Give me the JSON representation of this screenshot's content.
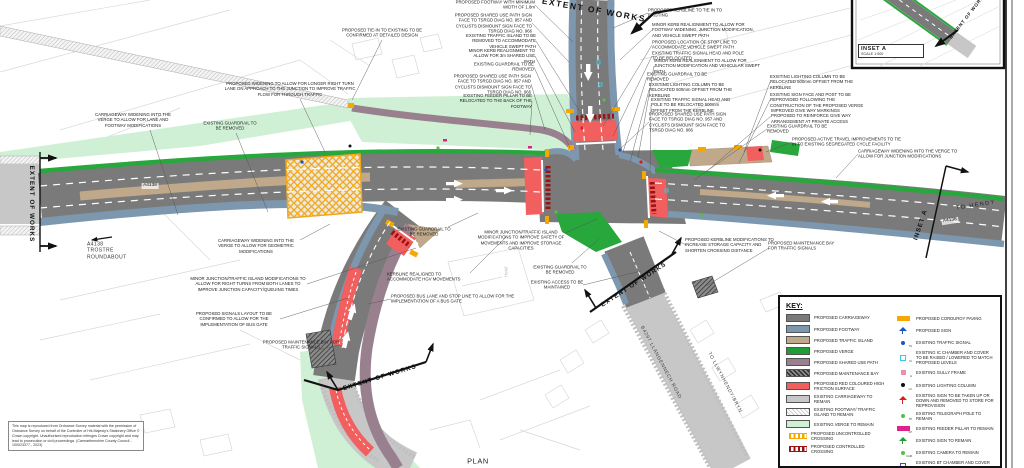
{
  "colors": {
    "proposed_carriageway": "#7a7a7a",
    "proposed_footway": "#7d97ae",
    "traffic_island": "#c0a88a",
    "proposed_verge": "#27a73c",
    "shared_use_path": "#99808f",
    "red_surface": "#f15f5f",
    "existing_carriageway": "#c7c7c7",
    "existing_verge": "#cff0d4",
    "corduroy": "#f5a800",
    "controlled_crossing": "#9b1313",
    "sign_blue": "#1657c7",
    "sign_red": "#d81f1f",
    "sign_green": "#1e9e35"
  },
  "inset": {
    "title": "INSET A",
    "scale": "SCALE 1:500"
  },
  "plan_title": "PLAN",
  "notes": "This map is reproduced from Ordnance Survey material with the permission of Ordnance Survey on behalf of the Controller of His Majesty's Stationery Office © Crown copyright. Unauthorised reproduction infringes Crown copyright and may lead to prosecution or civil proceedings. (Carmarthenshire County Council - 100023377 - 2023)",
  "key": {
    "title": "KEY:",
    "left": [
      {
        "label": "PROPOSED CARRIAGEWAY",
        "type": "solid",
        "color": "#7a7a7a"
      },
      {
        "label": "PROPOSED FOOTWAY",
        "type": "solid",
        "color": "#7d97ae"
      },
      {
        "label": "PROPOSED TRAFFIC ISLAND",
        "type": "solid",
        "color": "#c0a88a"
      },
      {
        "label": "PROPOSED VERGE",
        "type": "solid",
        "color": "#1f9e35"
      },
      {
        "label": "PROPOSED SHARED USE PATH",
        "type": "solid",
        "color": "#99808f"
      },
      {
        "label": "PROPOSED MAINTENANCE BAY",
        "type": "hatch-dark"
      },
      {
        "label": "PROPOSED RED COLOURED HIGH FRICTION SURFACE",
        "type": "solid",
        "color": "#f15f5f"
      },
      {
        "label": "EXISTING CARRIAGEWAY TO REMAIN",
        "type": "solid",
        "color": "#c7c7c7"
      },
      {
        "label": "EXISTING FOOTWAY/ TRAFFIC ISLAND TO REMAIN",
        "type": "hatch-light"
      },
      {
        "label": "EXISTING VERGE TO REMAIN",
        "type": "solid",
        "color": "#cff0d4"
      },
      {
        "label": "PROPOSED UNCONTROLLED CROSSING",
        "type": "ticks",
        "color": "#f5a800"
      },
      {
        "label": "PROPOSED CONTROLLED CROSSING",
        "type": "ticks",
        "color": "#9b1313"
      }
    ],
    "right": [
      {
        "label": "PROPOSED CORDUROY PAVING",
        "type": "bar",
        "color": "#f5a800"
      },
      {
        "label": "PROPOSED SIGN",
        "type": "sign",
        "color": "#1657c7"
      },
      {
        "label": "EXISTING TRAFFIC SIGNAL",
        "type": "dot",
        "color": "#1657c7",
        "sub": "TS"
      },
      {
        "label": "EXISTING IC CHAMBER AND COVER TO BE RAISED / LOWERED TO MATCH PROPOSED LEVELS",
        "type": "square",
        "color": "#39c6e8",
        "sub": "IC"
      },
      {
        "label": "EXISTING GULLY FRAME",
        "type": "square-fill",
        "color": "#f08ab4",
        "sub": "G"
      },
      {
        "label": "EXISTING LIGHTING COLUMN",
        "type": "dot",
        "color": "#111111",
        "sub": "LC"
      },
      {
        "label": "EXISTING SIGN TO BE TAKEN UP OR DOWN AND REMOVED TO STORE FOR REPROVISION",
        "type": "sign",
        "color": "#d81f1f"
      },
      {
        "label": "EXISTING TELEGRAPH POLE TO REMAIN",
        "type": "dot",
        "color": "#52c141",
        "sub": "TP"
      },
      {
        "label": "EXISTING FEEDER PILLAR TO REMAIN",
        "type": "bar",
        "color": "#e0218a",
        "sub": "FP"
      },
      {
        "label": "EXISTING SIGN TO REMAIN",
        "type": "sign",
        "color": "#1e9e35"
      },
      {
        "label": "EXISTING CAMERA TO REMAIN",
        "type": "dot",
        "color": "#52c141",
        "sub": "CAM"
      },
      {
        "label": "EXISTING BT CHAMBER AND COVER TO REMAIN",
        "type": "square",
        "color": "#7a2bd4",
        "sub": "BT"
      }
    ]
  },
  "labels": [
    {
      "n": "ann-footway-width",
      "t": "PROPOSED FOOTWAY WITH MINIMUM WIDTH OF 1.8m",
      "x": 495,
      "y": 5,
      "w": 80,
      "a": "r",
      "l": [
        535,
        5,
        573,
        42
      ]
    },
    {
      "n": "ann-shared-use-sign-nw",
      "t": "PROPOSED SHARED USE PATH SIGN FACE TO TSRGD DIAG NO. 957 AND CYCLISTS DISMOUNT SIGN FACE TO TSRGD DIAG NO. 966",
      "x": 490,
      "y": 23,
      "w": 84,
      "a": "r",
      "l": [
        532,
        23,
        569,
        62
      ]
    },
    {
      "n": "ann-traffic-island-removed",
      "t": "EXISTING TRAFFIC ISLAND TO BE REMOVED TO ACCOMMODATE VEHICLE SWEPT PATH",
      "x": 497,
      "y": 41,
      "w": 78,
      "a": "r",
      "l": [
        536,
        41,
        584,
        118
      ]
    },
    {
      "n": "ann-minor-kerb-3m",
      "t": "MINOR KERB REALIGNMENT TO ALLOW FOR 3m SHARED USE PATH",
      "x": 499,
      "y": 56,
      "w": 72,
      "a": "r",
      "l": [
        535,
        56,
        575,
        132
      ]
    },
    {
      "n": "ann-guardrail-nw",
      "t": "EXISTING GUARDRAIL TO BE REMOVED",
      "x": 502,
      "y": 67,
      "w": 64,
      "a": "r",
      "l": [
        534,
        67,
        570,
        148
      ]
    },
    {
      "n": "ann-shared-use-sign-w",
      "t": "PROPOSED SHARED USE PATH SIGN FACE TO TSRGD DIAG NO. 957 AND CYCLISTS DISMOUNT SIGN FACE TO TSRGD DIAG NO. 966",
      "x": 489,
      "y": 84,
      "w": 84,
      "a": "r",
      "l": [
        531,
        84,
        545,
        130
      ]
    },
    {
      "n": "ann-feeder-pillar",
      "t": "EXISTING FEEDER PILLAR TO BE RELOCATED TO THE BACK OF THE FOOTWAY",
      "x": 494,
      "y": 101,
      "w": 76,
      "a": "r",
      "l": [
        532,
        101,
        530,
        135
      ]
    },
    {
      "n": "ann-kerbline-tie-in",
      "t": "PROPOSED KERBLINE TO TIE IN TO EXISTING",
      "x": 686,
      "y": 13,
      "w": 76,
      "a": "l",
      "l": [
        648,
        13,
        613,
        28
      ]
    },
    {
      "n": "ann-kerb-footway-widening",
      "t": "MINOR KERB REALIGNMENT TO ALLOW FOR FOOTWAY WIDENING, JUNCTION MODIFICATION, AND VEHICLE SWEPT PATH",
      "x": 704,
      "y": 30,
      "w": 104,
      "a": "l",
      "l": [
        652,
        30,
        620,
        60
      ]
    },
    {
      "n": "ann-stop-line",
      "t": "PROPOSED LOCATION OF STOP LINE TO ACCOMMODATE VEHICLE SWEPT PATH",
      "x": 700,
      "y": 45,
      "w": 96,
      "a": "l",
      "l": [
        652,
        45,
        603,
        126
      ]
    },
    {
      "n": "ann-signal-relocated",
      "t": "EXISTING TRAFFIC SIGNAL HEAD AND POLE TO BE RELOCATED",
      "x": 698,
      "y": 56,
      "w": 92,
      "a": "l",
      "l": [
        652,
        56,
        613,
        136
      ]
    },
    {
      "n": "ann-kerb-junction-mod",
      "t": "MINOR KERB REALIGNMENT TO ALLOW FOR JUNCTION MODIFICATION AND VEHICULAR SWEPT PATH",
      "x": 708,
      "y": 66,
      "w": 108,
      "a": "l",
      "l": [
        654,
        66,
        638,
        158
      ]
    },
    {
      "n": "ann-guardrail-ne",
      "t": "EXISTING GUARDRAIL TO BE REMOVED",
      "x": 679,
      "y": 77,
      "w": 64,
      "a": "l",
      "l": [
        647,
        77,
        623,
        152
      ]
    },
    {
      "n": "ann-lighting-column-ne",
      "t": "EXISTING LIGHTING COLUMN TO BE RELOCATED 500mm OFFSET FROM THE KERBLINE",
      "x": 692,
      "y": 90,
      "w": 86,
      "a": "l",
      "l": [
        649,
        90,
        630,
        162
      ]
    },
    {
      "n": "ann-signal-500mm",
      "t": "EXISTING TRAFFIC SIGNAL HEAD AND POLE TO BE RELOCATED 500mm OFFSET FROM THE KERBLINE",
      "x": 694,
      "y": 105,
      "w": 86,
      "a": "l",
      "l": [
        651,
        105,
        650,
        172
      ]
    },
    {
      "n": "ann-shared-use-sign-ne",
      "t": "PROPOSED SHARED USE PATH SIGN FACE TO TSRGD DIAG NO. 957 AND CYCLISTS DISMOUNT SIGN FACE TO TSRGD DIAG NO. 966",
      "x": 691,
      "y": 122,
      "w": 84,
      "a": "l",
      "l": [
        649,
        122,
        619,
        150
      ]
    },
    {
      "n": "ann-lighting-column-e",
      "t": "EXISTING LIGHTING COLUMN TO BE RELOCATED 500mm OFFSET FROM THE KERBLINE",
      "x": 812,
      "y": 82,
      "w": 84,
      "a": "l",
      "l": [
        770,
        82,
        744,
        152
      ]
    },
    {
      "n": "ann-sign-reprovided",
      "t": "EXISTING SIGN FACE AND POST TO BE REPROVIDED FOLLOWING THE CONSTRUCTION OF THE PROPOSED VERGE",
      "x": 817,
      "y": 100,
      "w": 94,
      "a": "l",
      "l": [
        770,
        100,
        739,
        163
      ]
    },
    {
      "n": "ann-give-way",
      "t": "IMPROVED GIVE WAY MARKINGS PROPOSED TO REINFORCE GIVE WAY ARRANGEMENT AT PRIVATE ACCESS",
      "x": 816,
      "y": 116,
      "w": 90,
      "a": "l",
      "l": [
        771,
        116,
        706,
        172
      ]
    },
    {
      "n": "ann-guardrail-e",
      "t": "EXISTING GUARDRAIL TO BE REMOVED",
      "x": 799,
      "y": 129,
      "w": 64,
      "a": "l",
      "l": [
        767,
        129,
        694,
        180
      ]
    },
    {
      "n": "ann-active-travel",
      "t": "PROPOSED ACTIVE TRAVEL IMPROVEMENTS TO TIE IN TO EXISTING SEGREGATED CYCLE FACILITY",
      "x": 848,
      "y": 142,
      "w": 112,
      "a": "l",
      "l": [
        792,
        142,
        766,
        152
      ]
    },
    {
      "n": "ann-cw-widening-junction",
      "t": "CARRIAGEWAY WIDENING INTO THE VERGE TO ALLOW FOR JUNCTION MODIFICATIONS",
      "x": 912,
      "y": 154,
      "w": 108,
      "a": "l",
      "l": [
        858,
        154,
        836,
        178
      ]
    },
    {
      "n": "ann-tie-in-detailed",
      "t": "PROPOSED TIE-IN TO EXISTING TO BE CONFIRMED AT DETAILED DESIGN",
      "x": 382,
      "y": 33,
      "w": 102,
      "a": "c",
      "l": [
        382,
        40,
        352,
        100
      ]
    },
    {
      "n": "ann-right-turn-widening",
      "t": "PROPOSED WIDENING TO ALLOW FOR LONGER RIGHT TURN LANE ON APPROACH TO THE JUNCTION TO IMPROVE TRAFFIC FLOW FOR THROUGH TRAFFIC",
      "x": 290,
      "y": 89,
      "w": 132,
      "a": "c",
      "l": [
        300,
        99,
        325,
        152
      ]
    },
    {
      "n": "ann-cw-widening-lane",
      "t": "CARRIAGEWAY WIDENING INTO THE VERGE TO ALLOW FOR LANE AND FOOTWAY MODIFICATIONS",
      "x": 133,
      "y": 120,
      "w": 88,
      "a": "c",
      "l": [
        150,
        130,
        178,
        215
      ]
    },
    {
      "n": "ann-guardrail-w",
      "t": "EXISTING GUARDRAIL TO BE REMOVED",
      "x": 230,
      "y": 126,
      "w": 60,
      "a": "c",
      "l": [
        236,
        133,
        268,
        212
      ]
    },
    {
      "n": "ann-cw-widening-geometric",
      "t": "CARRIAGEWAY WIDENING INTO THE VERGE TO ALLOW FOR GEOMETRIC MODIFICATIONS",
      "x": 256,
      "y": 246,
      "w": 88,
      "a": "c",
      "l": [
        300,
        240,
        330,
        224
      ]
    },
    {
      "n": "ann-junction-mod-right-turns",
      "t": "MINOR JUNCTION/TRAFFIC ISLAND MODIFICATIONS TO ALLOW FOR RIGHT TURNS FROM BOTH LANES TO IMPROVE JUNCTION CAPACITY/QUEUING TIMES",
      "x": 248,
      "y": 284,
      "w": 118,
      "a": "c",
      "l": [
        307,
        284,
        416,
        248
      ]
    },
    {
      "n": "ann-signals-layout",
      "t": "PROPOSED SIGNALS LAYOUT TO BE CONFIRMED TO ALLOW FOR THE IMPLEMENTATION OF BUS GATE",
      "x": 234,
      "y": 319,
      "w": 92,
      "a": "c",
      "l": [
        280,
        319,
        348,
        298
      ]
    },
    {
      "n": "ann-maintenance-bay-sw",
      "t": "PROPOSED MAINTENANCE BAY FOR TRAFFIC SIGNALS",
      "x": 301,
      "y": 345,
      "w": 78,
      "a": "c",
      "l": [
        340,
        345,
        318,
        350
      ]
    },
    {
      "n": "ann-bus-lane",
      "t": "PROPOSED BUS LANE AND STOP LINE TO ALLOW FOR THE IMPLEMENTATION OF A BUS GATE",
      "x": 455,
      "y": 299,
      "w": 128,
      "a": "l",
      "l": [
        391,
        299,
        368,
        304
      ]
    },
    {
      "n": "ann-kerbline-hgv",
      "t": "KERBLINE REALIGNED TO ACCOMMODATE HGV MOVEMENTS",
      "x": 428,
      "y": 277,
      "w": 82,
      "a": "l",
      "l": [
        470,
        273,
        506,
        237
      ]
    },
    {
      "n": "ann-guardrail-sw",
      "t": "EXISTING GUARDRAIL TO BE REMOVED",
      "x": 424,
      "y": 232,
      "w": 60,
      "a": "c",
      "l": [
        448,
        227,
        478,
        213
      ]
    },
    {
      "n": "ann-junction-mod-safety",
      "t": "MINOR JUNCTION/TRAFFIC ISLAND MODIFICATIONS TO IMPROVE SAFETY OF MOVEMENTS AND IMPROVE STORAGE CAPACITIES",
      "x": 521,
      "y": 240,
      "w": 104,
      "a": "c",
      "l": [
        565,
        233,
        597,
        219
      ]
    },
    {
      "n": "ann-guardrail-se",
      "t": "EXISTING GUARDRAIL TO BE REMOVED",
      "x": 560,
      "y": 270,
      "w": 60,
      "a": "c",
      "l": [
        572,
        263,
        599,
        239
      ]
    },
    {
      "n": "ann-access-maintained",
      "t": "EXISTING ACCESS TO BE MAINTAINED",
      "x": 557,
      "y": 285,
      "w": 60,
      "a": "c",
      "l": [
        583,
        285,
        641,
        271
      ]
    },
    {
      "n": "ann-kerbline-storage",
      "t": "PROPOSED KERBLINE MODIFICATIONS TO INCREASE STORAGE CAPACITY AND SHORTEN CROSSING DISTANCE",
      "x": 731,
      "y": 245,
      "w": 92,
      "a": "l",
      "l": [
        686,
        245,
        659,
        231
      ]
    },
    {
      "n": "ann-maintenance-bay-se",
      "t": "PROPOSED MAINTENANCE BAY FOR TRAFFIC SIGNALS",
      "x": 806,
      "y": 246,
      "w": 76,
      "a": "l",
      "l": [
        769,
        248,
        706,
        286
      ]
    },
    {
      "n": "road-label-a4138-west",
      "t": "A4138",
      "x": 150,
      "y": 186,
      "c": "road-chip"
    },
    {
      "n": "road-label-trostre",
      "t": "A4138\nTROSTRE\nROUNDABOUT",
      "x": 116,
      "y": 251,
      "w": 58,
      "a": "l",
      "c": "road"
    },
    {
      "n": "road-label-to-hendy",
      "t": "TO HENDY",
      "x": 976,
      "y": 206,
      "r": -9,
      "c": "road-sp"
    },
    {
      "n": "road-label-a4138-east",
      "t": "A4138",
      "x": 950,
      "y": 221,
      "r": -9,
      "c": "road-chip"
    },
    {
      "n": "inset-a-boundary-label",
      "t": "INSET A",
      "x": 921,
      "y": 225,
      "r": -72,
      "c": "extent"
    },
    {
      "n": "road-label-b4297",
      "t": "B4297 LLANGENNECH ROAD",
      "x": 660,
      "y": 363,
      "r": 62,
      "c": "road-angled"
    },
    {
      "n": "road-label-llwynhendy",
      "t": "TO LLWYNHENDY/BRYN",
      "x": 724,
      "y": 383,
      "r": 62,
      "c": "road-angled"
    },
    {
      "n": "plan-title",
      "t": "PLAN",
      "x": 478,
      "y": 461,
      "c": "plan-label"
    },
    {
      "n": "extent-of-works-top",
      "t": "EXTENT OF WORKS",
      "x": 594,
      "y": 10,
      "r": 10,
      "c": "extent-big"
    },
    {
      "n": "extent-of-works-west",
      "t": "EXTENT OF WORKS",
      "x": 31,
      "y": 204,
      "r": 90,
      "c": "extent"
    },
    {
      "n": "extent-of-works-sw",
      "t": "EXTENT OF WORKS",
      "x": 380,
      "y": 378,
      "r": -17,
      "c": "extent"
    },
    {
      "n": "extent-of-works-se",
      "t": "EXTENT OF WORKS",
      "x": 634,
      "y": 285,
      "r": -33,
      "c": "extent"
    },
    {
      "n": "extent-of-works-inset",
      "t": "EXTENT OF WORKS",
      "x": 968,
      "y": 16,
      "r": -52,
      "c": "extent-sm"
    },
    {
      "n": "map-label-hotel",
      "t": "Hotel",
      "x": 506,
      "y": 272,
      "r": -90,
      "c": "map-label"
    }
  ]
}
